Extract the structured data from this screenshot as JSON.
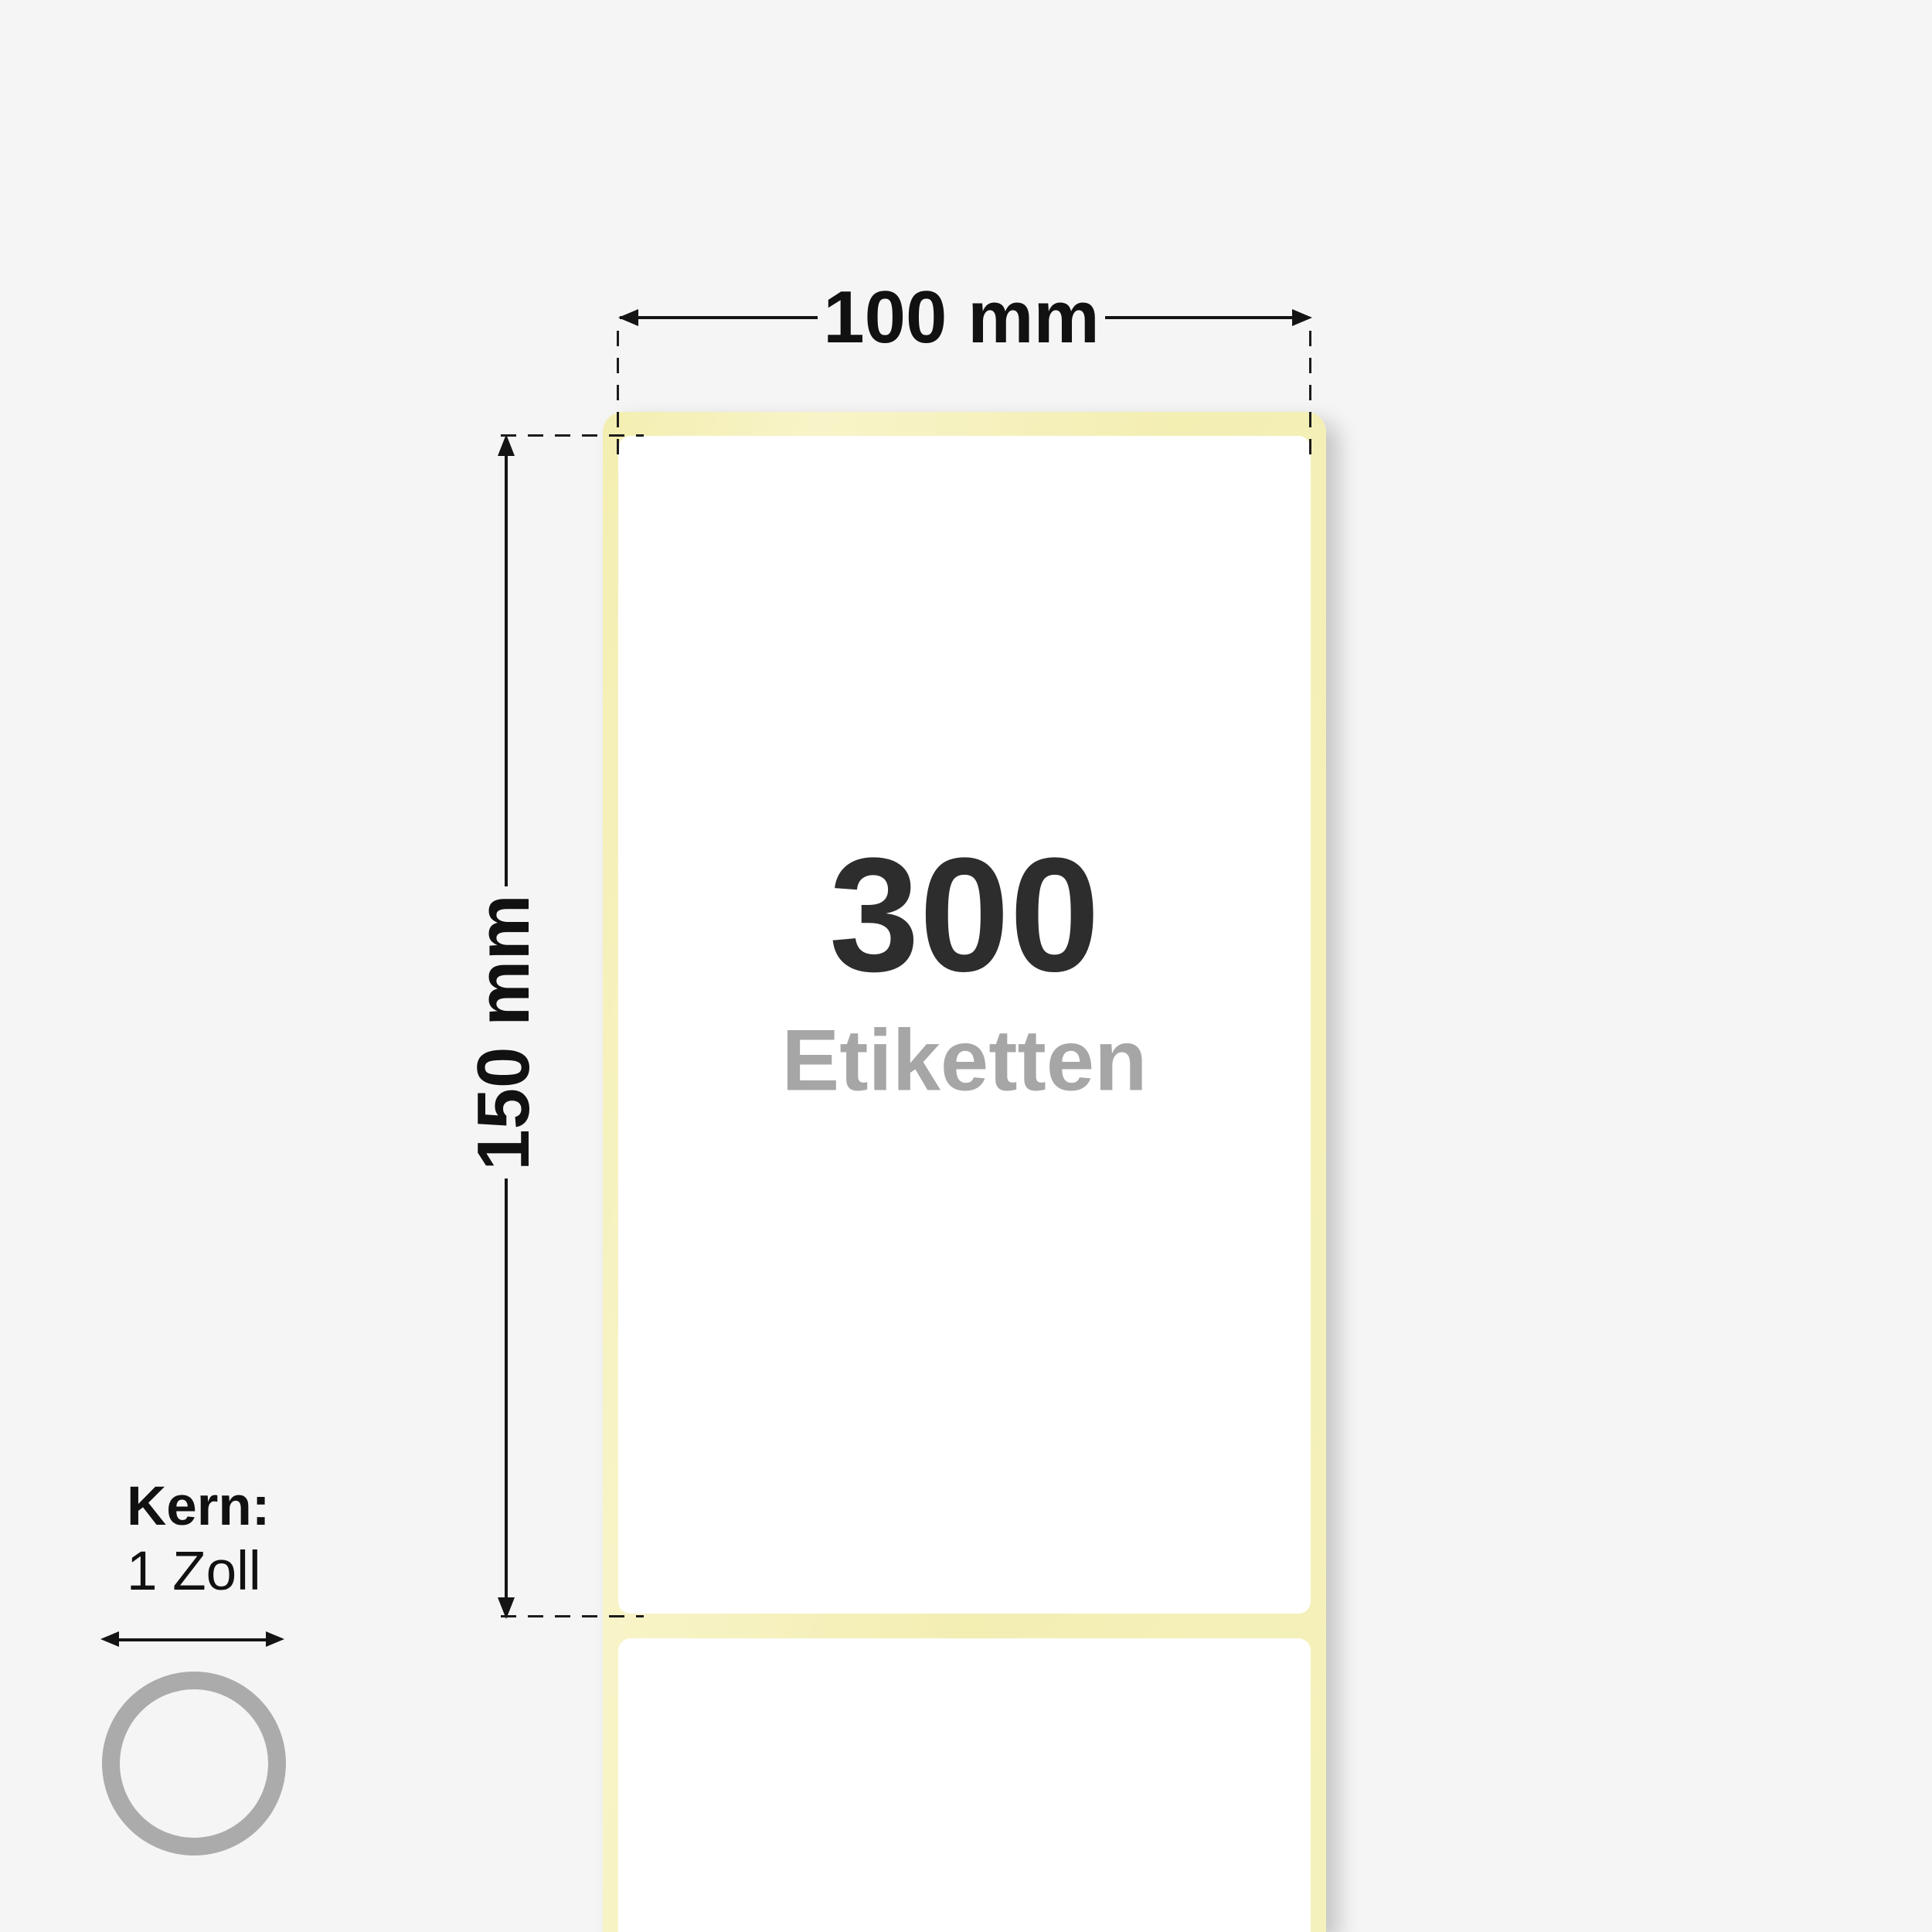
{
  "background_color": "#f5f5f5",
  "illustration": {
    "label_roll": {
      "count": "300",
      "count_word": "Etiketten",
      "count_color": "#2d2d2d",
      "count_word_color": "#a6a6a6",
      "label_color": "#ffffff",
      "liner_color": "#f5f1bc"
    },
    "dimensions": {
      "width_label": "100 mm",
      "height_label": "150 mm",
      "line_color": "#141414"
    },
    "core": {
      "title": "Kern:",
      "size": "1 Zoll",
      "ring_color": "#ababab"
    },
    "icons": {
      "ring": "core-ring-icon",
      "width_arrows": "width-dimension-arrow-icons",
      "height_arrows": "height-dimension-arrow-icons",
      "core_arrow": "core-diameter-arrow-icon"
    }
  }
}
